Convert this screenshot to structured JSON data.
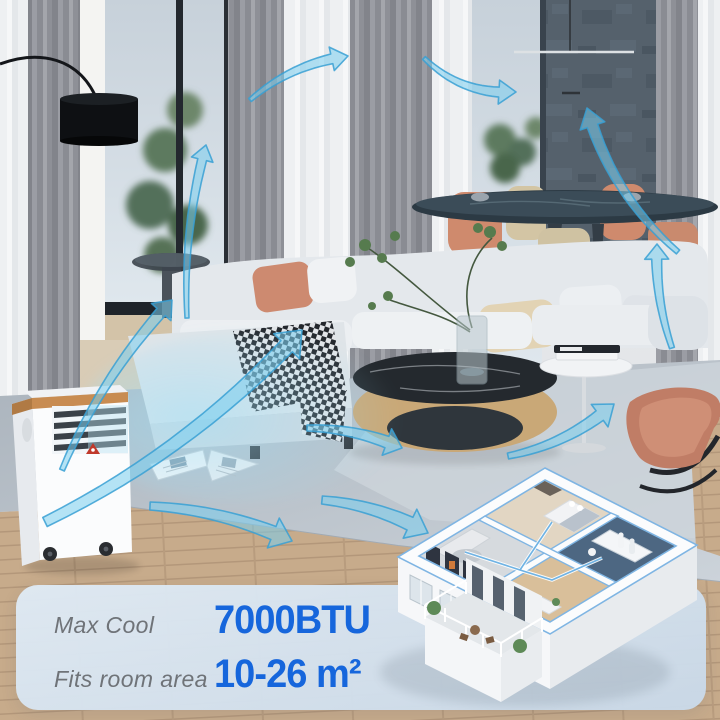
{
  "panel": {
    "rows": [
      {
        "label": "Max Cool",
        "value": "7000BTU"
      },
      {
        "label": "Fits room area",
        "value": "10-26 m²"
      }
    ]
  },
  "colors": {
    "accent_blue": "#1666DC",
    "label_gray": "#6F7378",
    "panel_bg": "#D3E1EE",
    "arrow_fill": "#7ACDEE",
    "arrow_stroke": "#38A0D4"
  },
  "scene": {
    "airflow_arrow_count": 11,
    "icons": {
      "airflow-arrow": "curved translucent blue arrow",
      "ac-unit": "white portable air conditioner with louver vent and casters",
      "apartment-floorplan": "isometric 3-room apartment cutaway with balcony"
    }
  }
}
